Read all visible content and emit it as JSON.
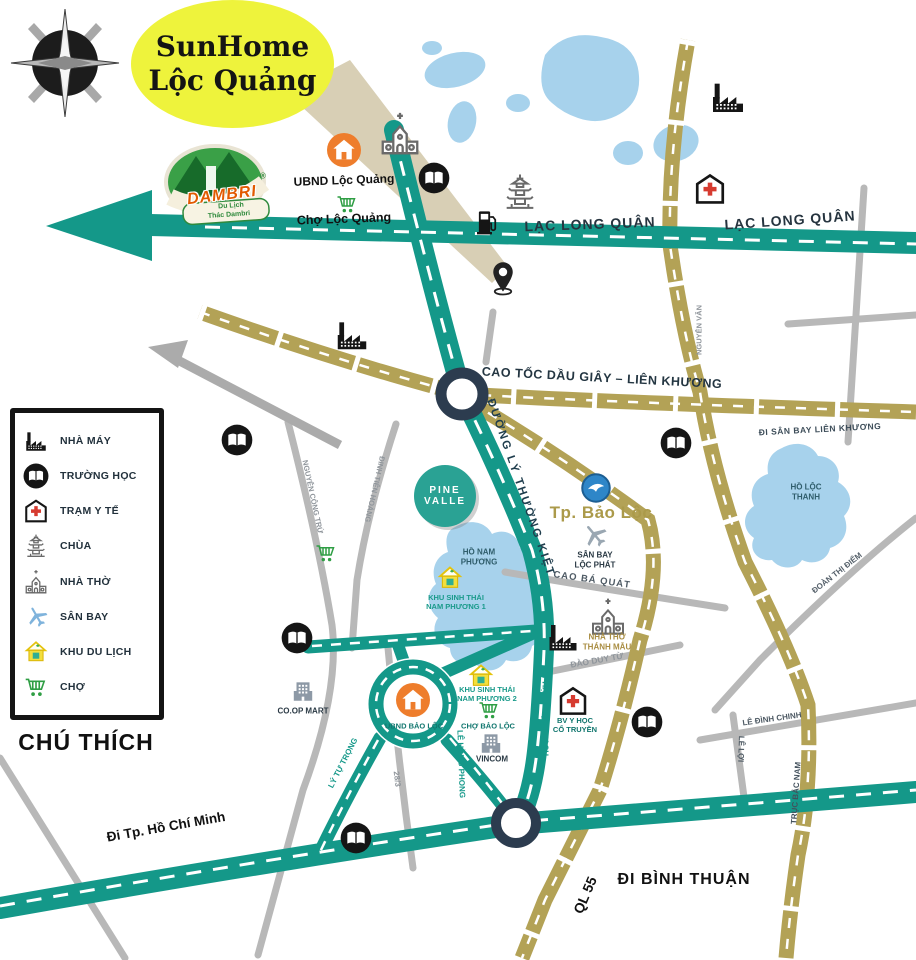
{
  "callout": {
    "line1": "SunHome",
    "line2": "Lộc Quảng"
  },
  "dambri": {
    "name": "DAMBRI",
    "reg": "®",
    "sub1": "Du Lịch",
    "sub2": "Thác Dambri"
  },
  "legend": {
    "title": "CHÚ THÍCH",
    "items": [
      {
        "icon": "factory-icon",
        "label": "NHÀ MÁY"
      },
      {
        "icon": "school-icon",
        "label": "TRƯỜNG HỌC"
      },
      {
        "icon": "clinic-icon",
        "label": "TRẠM Y TẾ"
      },
      {
        "icon": "pagoda-icon",
        "label": "CHÙA"
      },
      {
        "icon": "church-icon",
        "label": "NHÀ THỜ"
      },
      {
        "icon": "airport-icon",
        "label": "SÂN BAY"
      },
      {
        "icon": "resort-icon",
        "label": "KHU DU LỊCH"
      },
      {
        "icon": "market-icon",
        "label": "CHỢ"
      }
    ]
  },
  "places": {
    "ubnd_loc_quang": "UBND Lộc Quảng",
    "cho_loc_quang": "Chợ Lộc Quảng",
    "ubnd_bao_loc": "UBND BẢO LỘC",
    "cho_bao_loc": "CHỢ BẢO LỘC",
    "coop_mart": "CO.OP MART",
    "vincom": "VINCOM",
    "tp_bao_loc": "Tp. Bảo Lộc",
    "pine_valle": {
      "line1": "PINE",
      "line2": "VALLE"
    },
    "san_bay_loc_phat": {
      "line1": "SÂN BAY",
      "line2": "LỘC PHÁT"
    },
    "khu_sinh_thai_1": {
      "line1": "KHU SINH THÁI",
      "line2": "NAM PHƯƠNG 1"
    },
    "khu_sinh_thai_2": {
      "line1": "KHU SINH THÁI",
      "line2": "NAM PHƯƠNG 2"
    },
    "nha_tho_thanh_mau": {
      "line1": "NHÀ THỜ",
      "line2": "THÁNH MẪU"
    },
    "bv_y_hoc": {
      "line1": "BV Y HỌC",
      "line2": "CỔ TRUYỀN"
    },
    "ho_nam_phuong": {
      "line1": "HỒ NAM",
      "line2": "PHƯƠNG"
    },
    "ho_loc_thanh": {
      "line1": "HỒ LỘC",
      "line2": "THANH"
    }
  },
  "roads": {
    "lac_long_quan_1": "LẠC LONG QUÂN",
    "lac_long_quan_2": "LẠC LONG QUÂN",
    "cao_toc": "CAO TỐC DẦU GIÂY – LIÊN KHƯƠNG",
    "di_san_bay": "ĐI SÂN BAY LIÊN KHƯƠNG",
    "duong_ly_thuong_kiet": "ĐƯỜNG LÝ THƯỜNG KIỆT",
    "cao_ba_quat": "CAO BÁ QUÁT",
    "dao_duy_tu": "ĐÀO DUY TỪ",
    "doan_thi_diem": "ĐOÀN THỊ ĐIỂM",
    "le_dinh_chinh": "LÊ ĐÌNH CHINH",
    "le_loi": "LÊ LỢI",
    "truc_bac_nam": "TRỤC BẮC NAM",
    "nguyen_van": "NGUYỄN VĂN",
    "nguyen_cong_tru": "NGUYỄN CÔNG TRỨ",
    "dinh_tien_hoang": "ĐINH TIÊN HOÀNG",
    "pham_ngoc_thach": "PHẠM NGỌC THẠCH",
    "le_hong_phong": "LÊ HỒNG PHONG",
    "ly_tu_trong": "LÝ TỰ TRỌNG",
    "duong_28_3": "28/3",
    "ql_55": "QL 55",
    "di_binh_thuan": "ĐI BÌNH THUẬN",
    "di_tp_hcm": "Đi Tp. Hồ Chí Minh"
  },
  "colors": {
    "teal_road": "#149889",
    "tan_road": "#b3a256",
    "gray_road": "#b8b8b8",
    "lake": "#a7d2ec",
    "junction_navy": "#2c3c4f",
    "orange_marker": "#ee7d2c",
    "callout_yellow": "#eef33c",
    "gold_text": "#ab9a4a"
  }
}
